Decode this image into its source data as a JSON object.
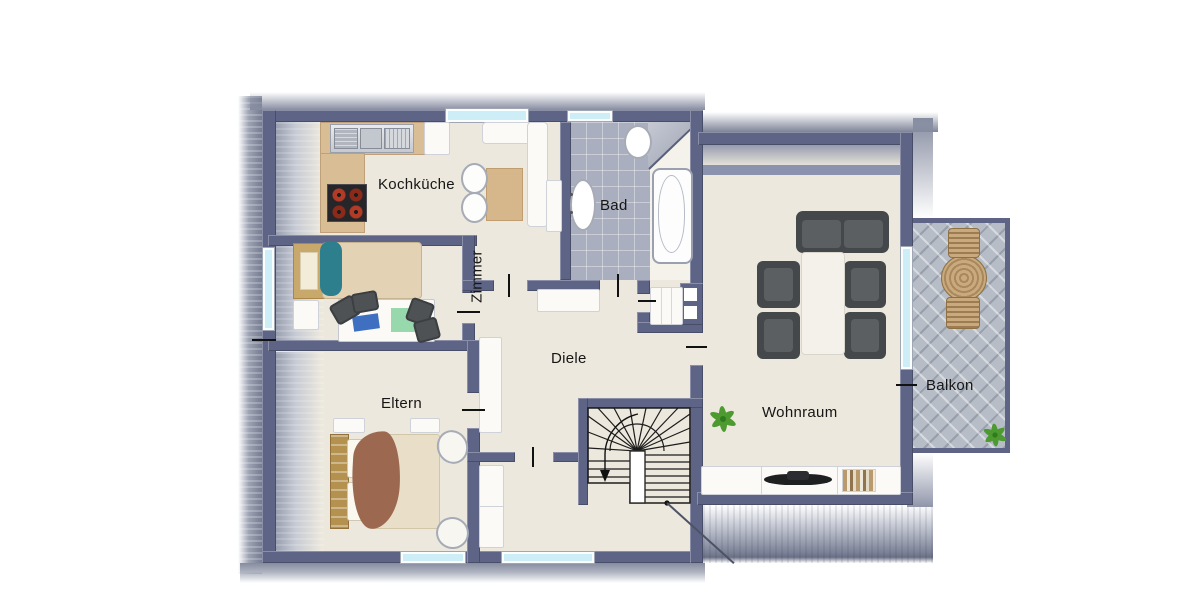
{
  "plan": {
    "rooms": {
      "kochkueche": {
        "label": "Kochküche"
      },
      "bad": {
        "label": "Bad"
      },
      "zimmer": {
        "label": "Zimmer"
      },
      "diele": {
        "label": "Diele"
      },
      "eltern": {
        "label": "Eltern"
      },
      "wohnraum": {
        "label": "Wohnraum"
      },
      "balkon": {
        "label": "Balkon"
      }
    },
    "colors": {
      "wall": "#5d6486",
      "knee_wall": "#8a92ad",
      "floor": "#ece8dd",
      "bath_tile": "#a9afbe",
      "balcony_tile": "#b7bdc7",
      "counter": "#d9bd95",
      "window_glass": "#cdeef7",
      "bed_teal": "#2e7f8e",
      "blanket_brown": "#9c6850",
      "wood": "#b5914f",
      "sofa_gray": "#45484a",
      "plant_green": "#4d9b30"
    },
    "furniture": [
      "kitchen-sink",
      "stove",
      "dining-table",
      "bathtub",
      "washbasin",
      "single-bed",
      "desk",
      "double-bed",
      "wardrobe",
      "staircase",
      "sofa-set",
      "coffee-table",
      "tv-sideboard",
      "balcony-table",
      "plant"
    ]
  }
}
